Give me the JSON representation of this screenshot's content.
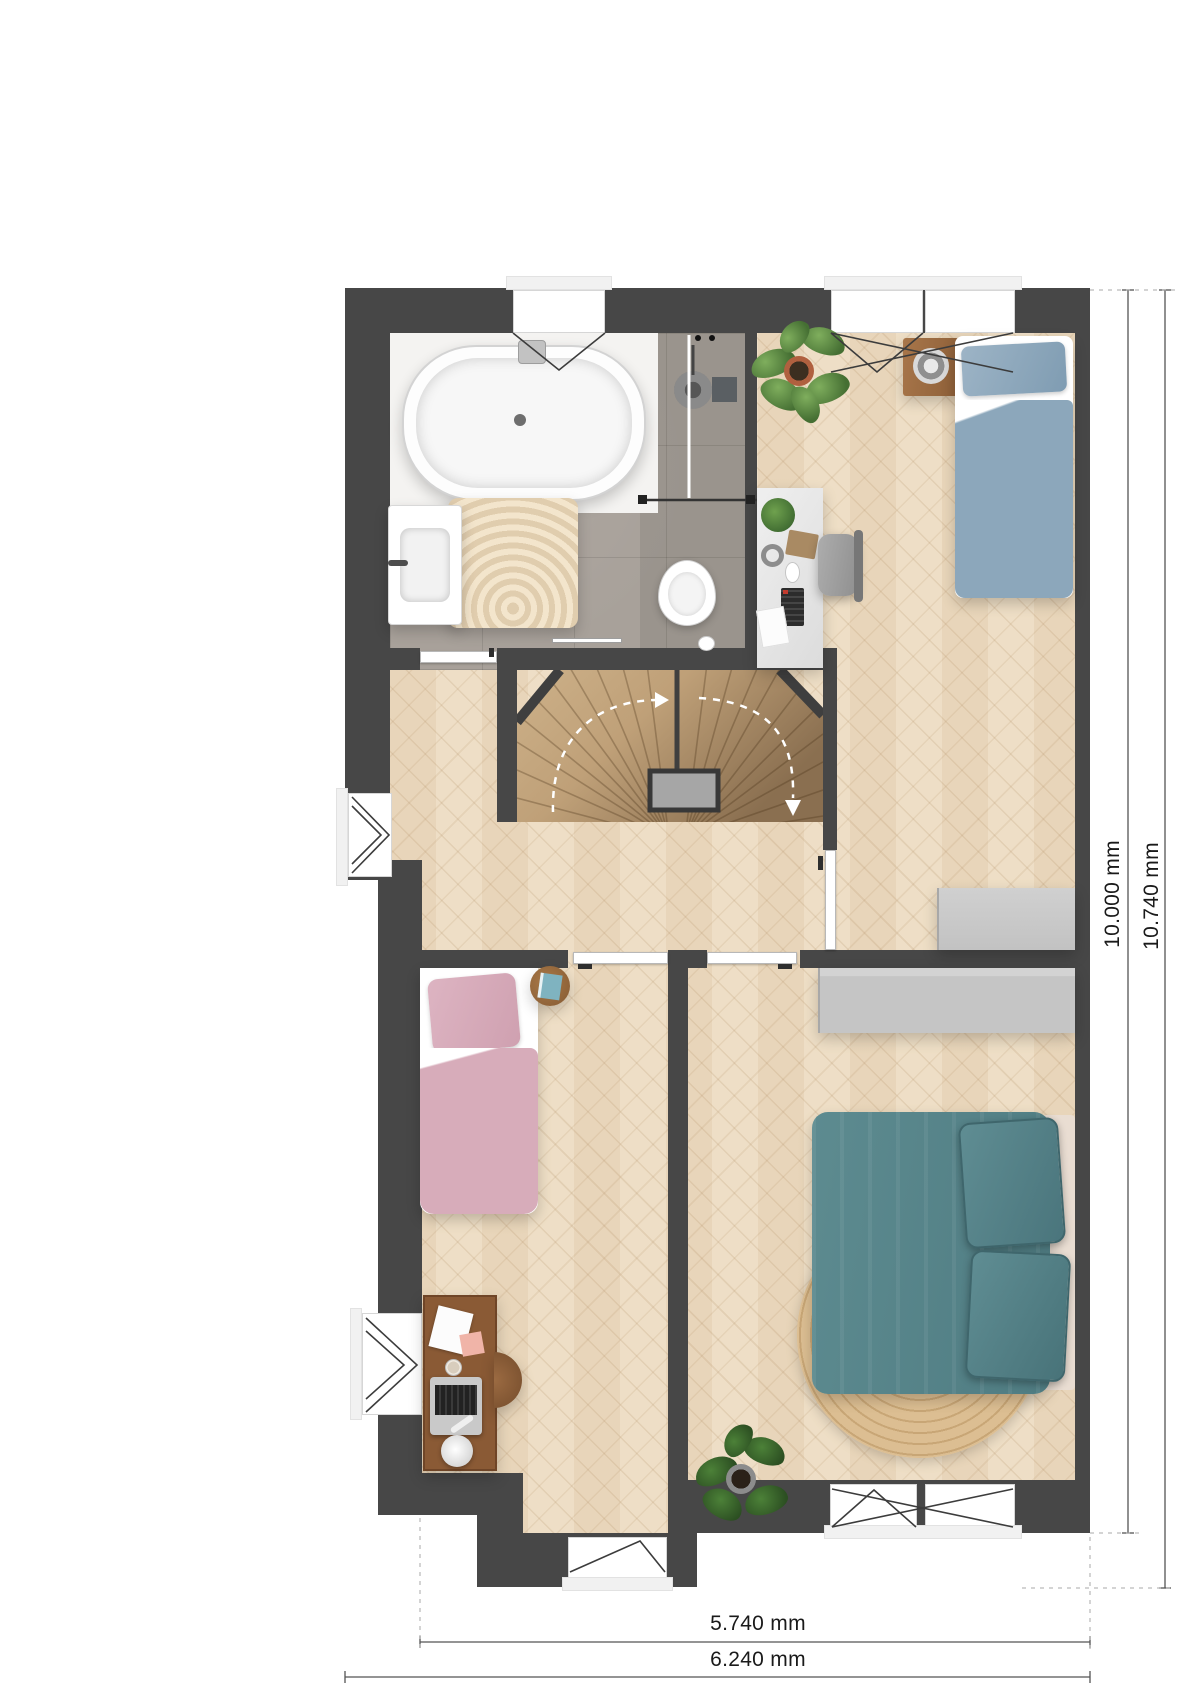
{
  "annotations": {
    "vertical": [
      {
        "label": "10.000 mm"
      },
      {
        "label": "10.740 mm"
      }
    ],
    "horizontal": [
      {
        "label": "5.740 mm"
      },
      {
        "label": "6.240 mm"
      }
    ]
  },
  "colors": {
    "wall": "#474747",
    "wall_dark": "#3a3a3a",
    "wood": "#ecdbc1",
    "tile": "#a8a19a",
    "stair_light": "#cdb189",
    "stair_dark": "#8a6f50",
    "landing": "#a6a6a6",
    "cabinet": "#c9c9c9",
    "blue_bed": "#8ca7bb",
    "pink_bed": "#d7acba",
    "teal_bed": "#578188",
    "teal_bed_dark": "#41666c",
    "rug": "#d9ba8e",
    "plant": "#4e7d38",
    "wood_furniture": "#8a5a35",
    "line": "#3c3c3c",
    "dim": "#555555",
    "text": "#1a1a1a"
  }
}
